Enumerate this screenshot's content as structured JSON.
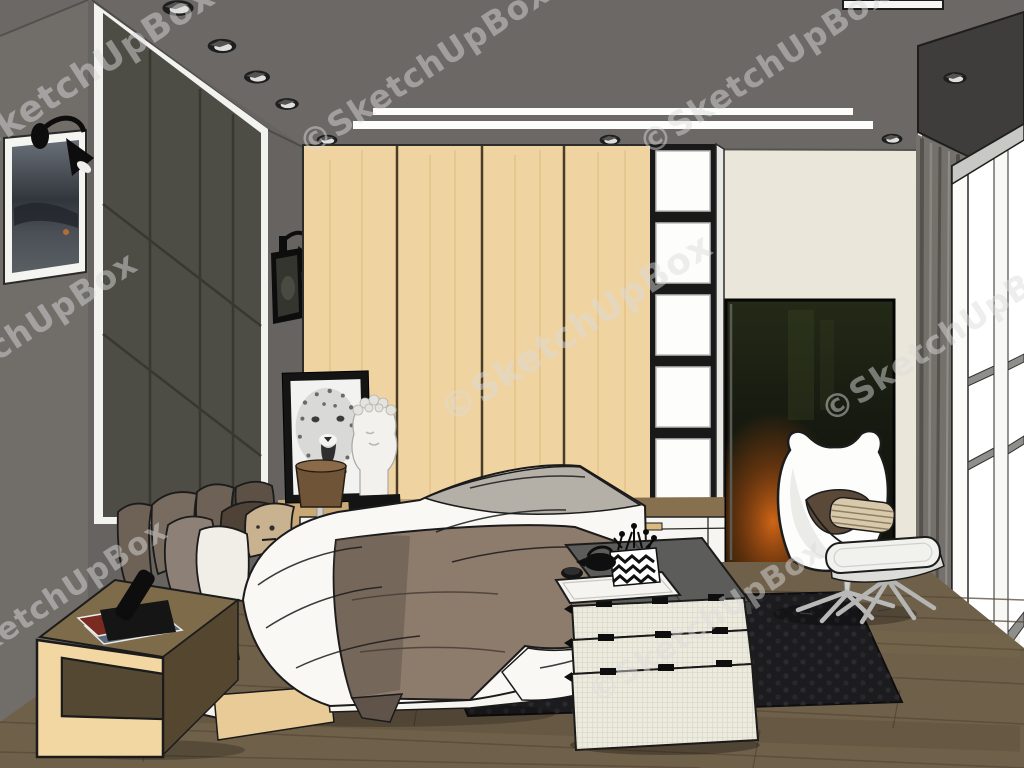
{
  "watermark": {
    "text": "©SketchUpBox"
  },
  "palette": {
    "ceiling": "#6b6865",
    "bulkhead": "#3f3d3b",
    "backWall": "#eae6da",
    "leftWall": "#716e6a",
    "featureWall": "#666360",
    "panel": "#4d4c45",
    "panelSeam": "#39382f",
    "trim": "#f2f2ef",
    "wood": "#efd4a2",
    "woodGap": "#4a3d28",
    "boxFrame": "#191919",
    "counter": "#86704d",
    "counterLight": "#cfae7c",
    "cabinet": "#f6f5f1",
    "handle": "#d9ba80",
    "floor": "#6f6049",
    "floorLine": "#574939",
    "rug": "#1c1c1f",
    "rugDot": "#2d2d33",
    "painting": "#13160e",
    "glow": "#c85c14",
    "curtain": "#74716c",
    "curtainDark": "#57544e",
    "shelfUnit": "#efeeea",
    "shelfTop": "#8e8e8b",
    "chair": "#fdfdfc",
    "cushion": "#5a4939",
    "pillowStripe": "#d9c9ab",
    "ottoman": "#f1f1ee",
    "chrome": "#bfbfbd",
    "bedWhite": "#f9f8f4",
    "bedShade": "#b5b0a7",
    "throw": "#8d7b6c",
    "throwDark": "#60534a",
    "platform": "#efece2",
    "plinth": "#e8cb96",
    "pillowDark": "#6e6156",
    "pillowBrown": "#4f4236",
    "pillowTan": "#c9b28f",
    "pillowWhite": "#f0eee7",
    "bench": "#5c5c5a",
    "mattress": "#edebdd",
    "tray": "#f5f4f0",
    "lampShade": "#6f5437",
    "ink": "#1b1b1b",
    "watermark": "#dcdcdc"
  },
  "scene": {
    "objects": [
      "ceiling-spotlights",
      "led-light-strips",
      "padded-headboard-wall",
      "framed-wall-art",
      "wall-spotlight-lamps",
      "wood-wardrobe",
      "display-shelf-column",
      "white-drawer-cabinet",
      "leopard-print-frame",
      "classical-bust",
      "table-lamp",
      "platform-bed",
      "pillows",
      "taupe-throw-blanket",
      "wood-side-table",
      "cordless-phone",
      "magazines",
      "foot-bench-folded-mattresses",
      "serving-tray-tea-set",
      "chevron-box",
      "dark-abstract-painting",
      "egg-chair",
      "striped-pillow",
      "ottoman",
      "gray-curtain",
      "white-shelving-unit",
      "dark-area-rug",
      "wood-floor"
    ]
  }
}
